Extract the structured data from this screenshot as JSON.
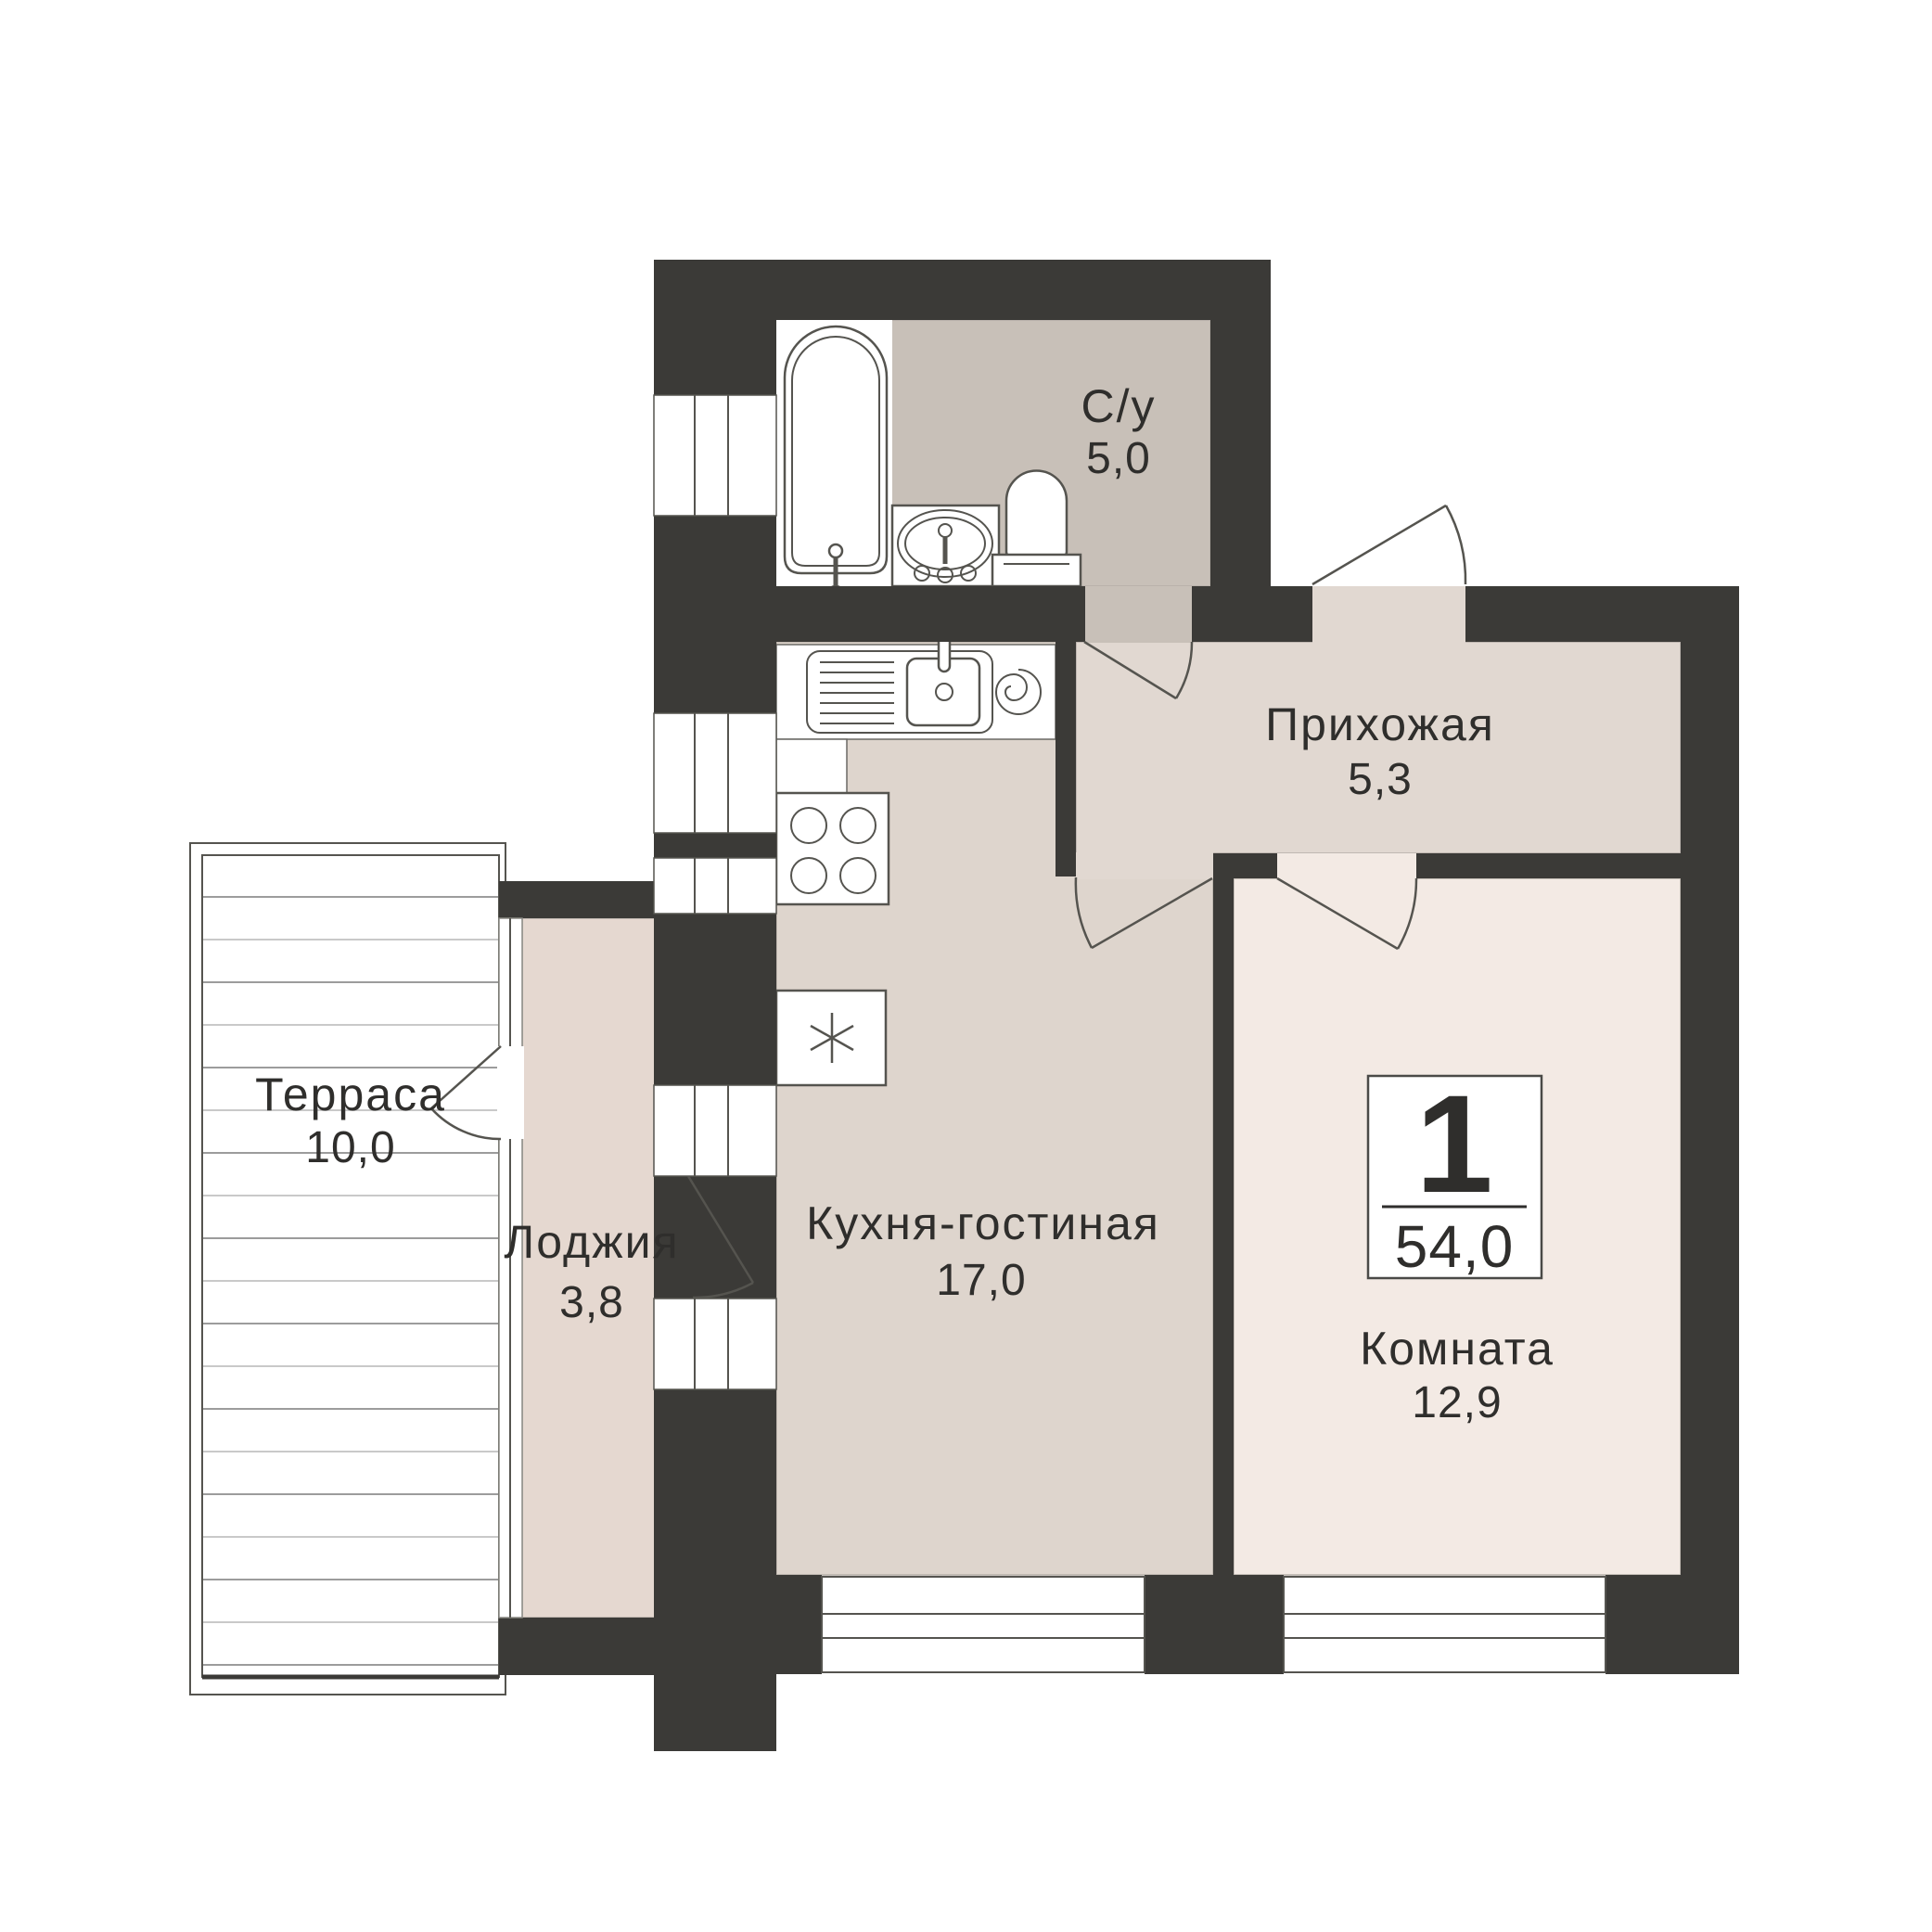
{
  "plan": {
    "badge": {
      "rooms_count": "1",
      "total_area": "54,0"
    }
  },
  "rooms": [
    {
      "id": "bathroom",
      "name": "С/у",
      "area": "5,0"
    },
    {
      "id": "hallway",
      "name": "Прихожая",
      "area": "5,3"
    },
    {
      "id": "kitchen_living",
      "name": "Кухня-гостиная",
      "area": "17,0"
    },
    {
      "id": "room",
      "name": "Комната",
      "area": "12,9"
    },
    {
      "id": "loggia",
      "name": "Лоджия",
      "area": "3,8"
    },
    {
      "id": "terrace",
      "name": "Терраса",
      "area": "10,0"
    }
  ],
  "colors": {
    "wall": "#3b3a37",
    "bathroom_fill": "#c8c0b8",
    "hallway_fill": "#e1d8d1",
    "kitchen_fill": "#ded5cd",
    "room_fill": "#f3eae4",
    "loggia_fill": "#e5d8d0",
    "fixture_outline": "#55544f",
    "text": "#2f2e2c",
    "badge_border": "#4a4a47"
  }
}
